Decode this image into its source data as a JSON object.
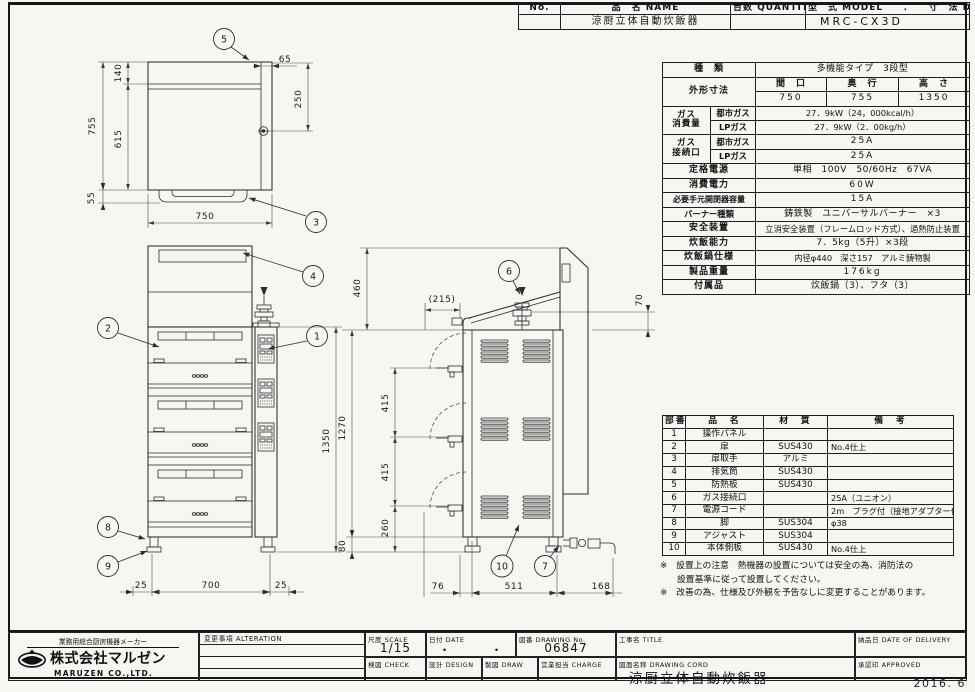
{
  "sheet": {
    "year_stamp": "2016. 6"
  },
  "header_table": {
    "no_label": "No.",
    "name_label": "品　名 NAME",
    "name_value": "涼厨立体自動炊飯器",
    "qty_label": "台数 QUANTITY",
    "model_dim_label": "型　式 MODEL　　．　　寸　法 DIMENSION",
    "model_value": "MRC-CX3D"
  },
  "spec_table": {
    "kind_label": "種　類",
    "kind_value": "多機能タイプ　3段型",
    "dims_label": "外形寸法",
    "width_label": "間　口",
    "depth_label": "奥　行",
    "height_label": "高　さ",
    "width_value": "750",
    "depth_value": "755",
    "height_value": "1350",
    "gas_consumption_label_1": "ガス",
    "gas_consumption_label_2": "消費量",
    "city_gas_label": "都市ガス",
    "lp_gas_label": "LPガス",
    "city_gas_consumption": "27．9kW（24，000kcal/h）",
    "lp_gas_consumption": "27．9kW（2．00kg/h）",
    "gas_connection_label_1": "ガス",
    "gas_connection_label_2": "接続口",
    "city_gas_connection": "25A",
    "lp_gas_connection": "25A",
    "power_label": "定格電源",
    "power_value": "単相　100V　50/60Hz　67VA",
    "consumption_label": "消費電力",
    "consumption_value": "60W",
    "breaker_label": "必要手元開閉器容量",
    "breaker_value": "15A",
    "burner_label": "バーナー種類",
    "burner_value": "鋳鉄製　ユニバーサルバーナー　×3",
    "safety_label": "安全装置",
    "safety_value": "立消安全装置（フレームロッド方式）、過熱防止装置",
    "capacity_label": "炊飯能力",
    "capacity_value": "7．5kg（5升）×3段",
    "pot_label": "炊飯鍋仕様",
    "pot_value": "内径φ440　深さ157　アルミ鋳物製",
    "weight_label": "製品重量",
    "weight_value": "176kg",
    "accessory_label": "付属品",
    "accessory_value": "炊飯鍋（3）、フタ（3）"
  },
  "parts_table": {
    "headers": {
      "no": "部番",
      "name": "品　名",
      "material": "材　質",
      "note": "備　考"
    },
    "rows": [
      {
        "no": "1",
        "name": "操作パネル",
        "material": "",
        "note": ""
      },
      {
        "no": "2",
        "name": "扉",
        "material": "SUS430",
        "note": "No.4仕上"
      },
      {
        "no": "3",
        "name": "扉取手",
        "material": "アルミ",
        "note": ""
      },
      {
        "no": "4",
        "name": "排気筒",
        "material": "SUS430",
        "note": ""
      },
      {
        "no": "5",
        "name": "防熱板",
        "material": "SUS430",
        "note": ""
      },
      {
        "no": "6",
        "name": "ガス接続口",
        "material": "",
        "note": "25A（ユニオン）"
      },
      {
        "no": "7",
        "name": "電源コード",
        "material": "",
        "note": "2m　プラグ付（接地アダプター付）"
      },
      {
        "no": "8",
        "name": "脚",
        "material": "SUS304",
        "note": "φ38"
      },
      {
        "no": "9",
        "name": "アジャスト",
        "material": "SUS304",
        "note": ""
      },
      {
        "no": "10",
        "name": "本体側板",
        "material": "SUS430",
        "note": "No.4仕上"
      }
    ]
  },
  "notes": {
    "line1": "※　設置上の注意　熱機器の設置については安全の為、消防法の",
    "line2": "設置基準に従って設置してください。",
    "line3": "※　改善の為、仕様及び外観を予告なしに変更することがあります。"
  },
  "title_block": {
    "maker_tagline": "業務用総合厨房機器メーカー",
    "company_logo_jp": "株式会社マルゼン",
    "company_en": "MARUZEN CO.,LTD.",
    "alteration_label": "変更事項 ALTERATION",
    "scale_label": "尺度 SCALE",
    "scale_value": "1/15",
    "date_label": "日付 DATE",
    "date_value": "・　　　・",
    "drawing_no_label": "図番 DRAWING No.",
    "drawing_no_value": "06847",
    "project_label": "工事名 TITLE",
    "check_label": "検図 CHECK",
    "design_label": "設計 DESIGN",
    "draw_label": "製図 DRAW",
    "charge_label": "営業担当 CHARGE",
    "drawing_name_label": "図面名称 DRAWING CORD",
    "drawing_name_value": "涼厨立体自動炊飯器",
    "delivery_label": "納品日 DATE OF DELIVERY",
    "approved_label": "承認印 APPROVED"
  },
  "drawing": {
    "balloons": {
      "b1": "1",
      "b2": "2",
      "b3": "3",
      "b4": "4",
      "b5": "5",
      "b6": "6",
      "b7": "7",
      "b8": "8",
      "b9": "9",
      "b10": "10"
    },
    "top_view": {
      "d755": "755",
      "d140": "140",
      "d615": "615",
      "d55": "55",
      "d750": "750",
      "d65": "65",
      "d250": "250"
    },
    "front_view": {
      "d1350": "1350",
      "d25l": "25",
      "d700": "700",
      "d25r": "25"
    },
    "side_view": {
      "d460": "460",
      "d215": "(215)",
      "d70": "70",
      "d1270": "1270",
      "d415a": "415",
      "d415b": "415",
      "d260": "260",
      "d80": "80",
      "d76": "76",
      "d511": "511",
      "d168": "168"
    }
  }
}
